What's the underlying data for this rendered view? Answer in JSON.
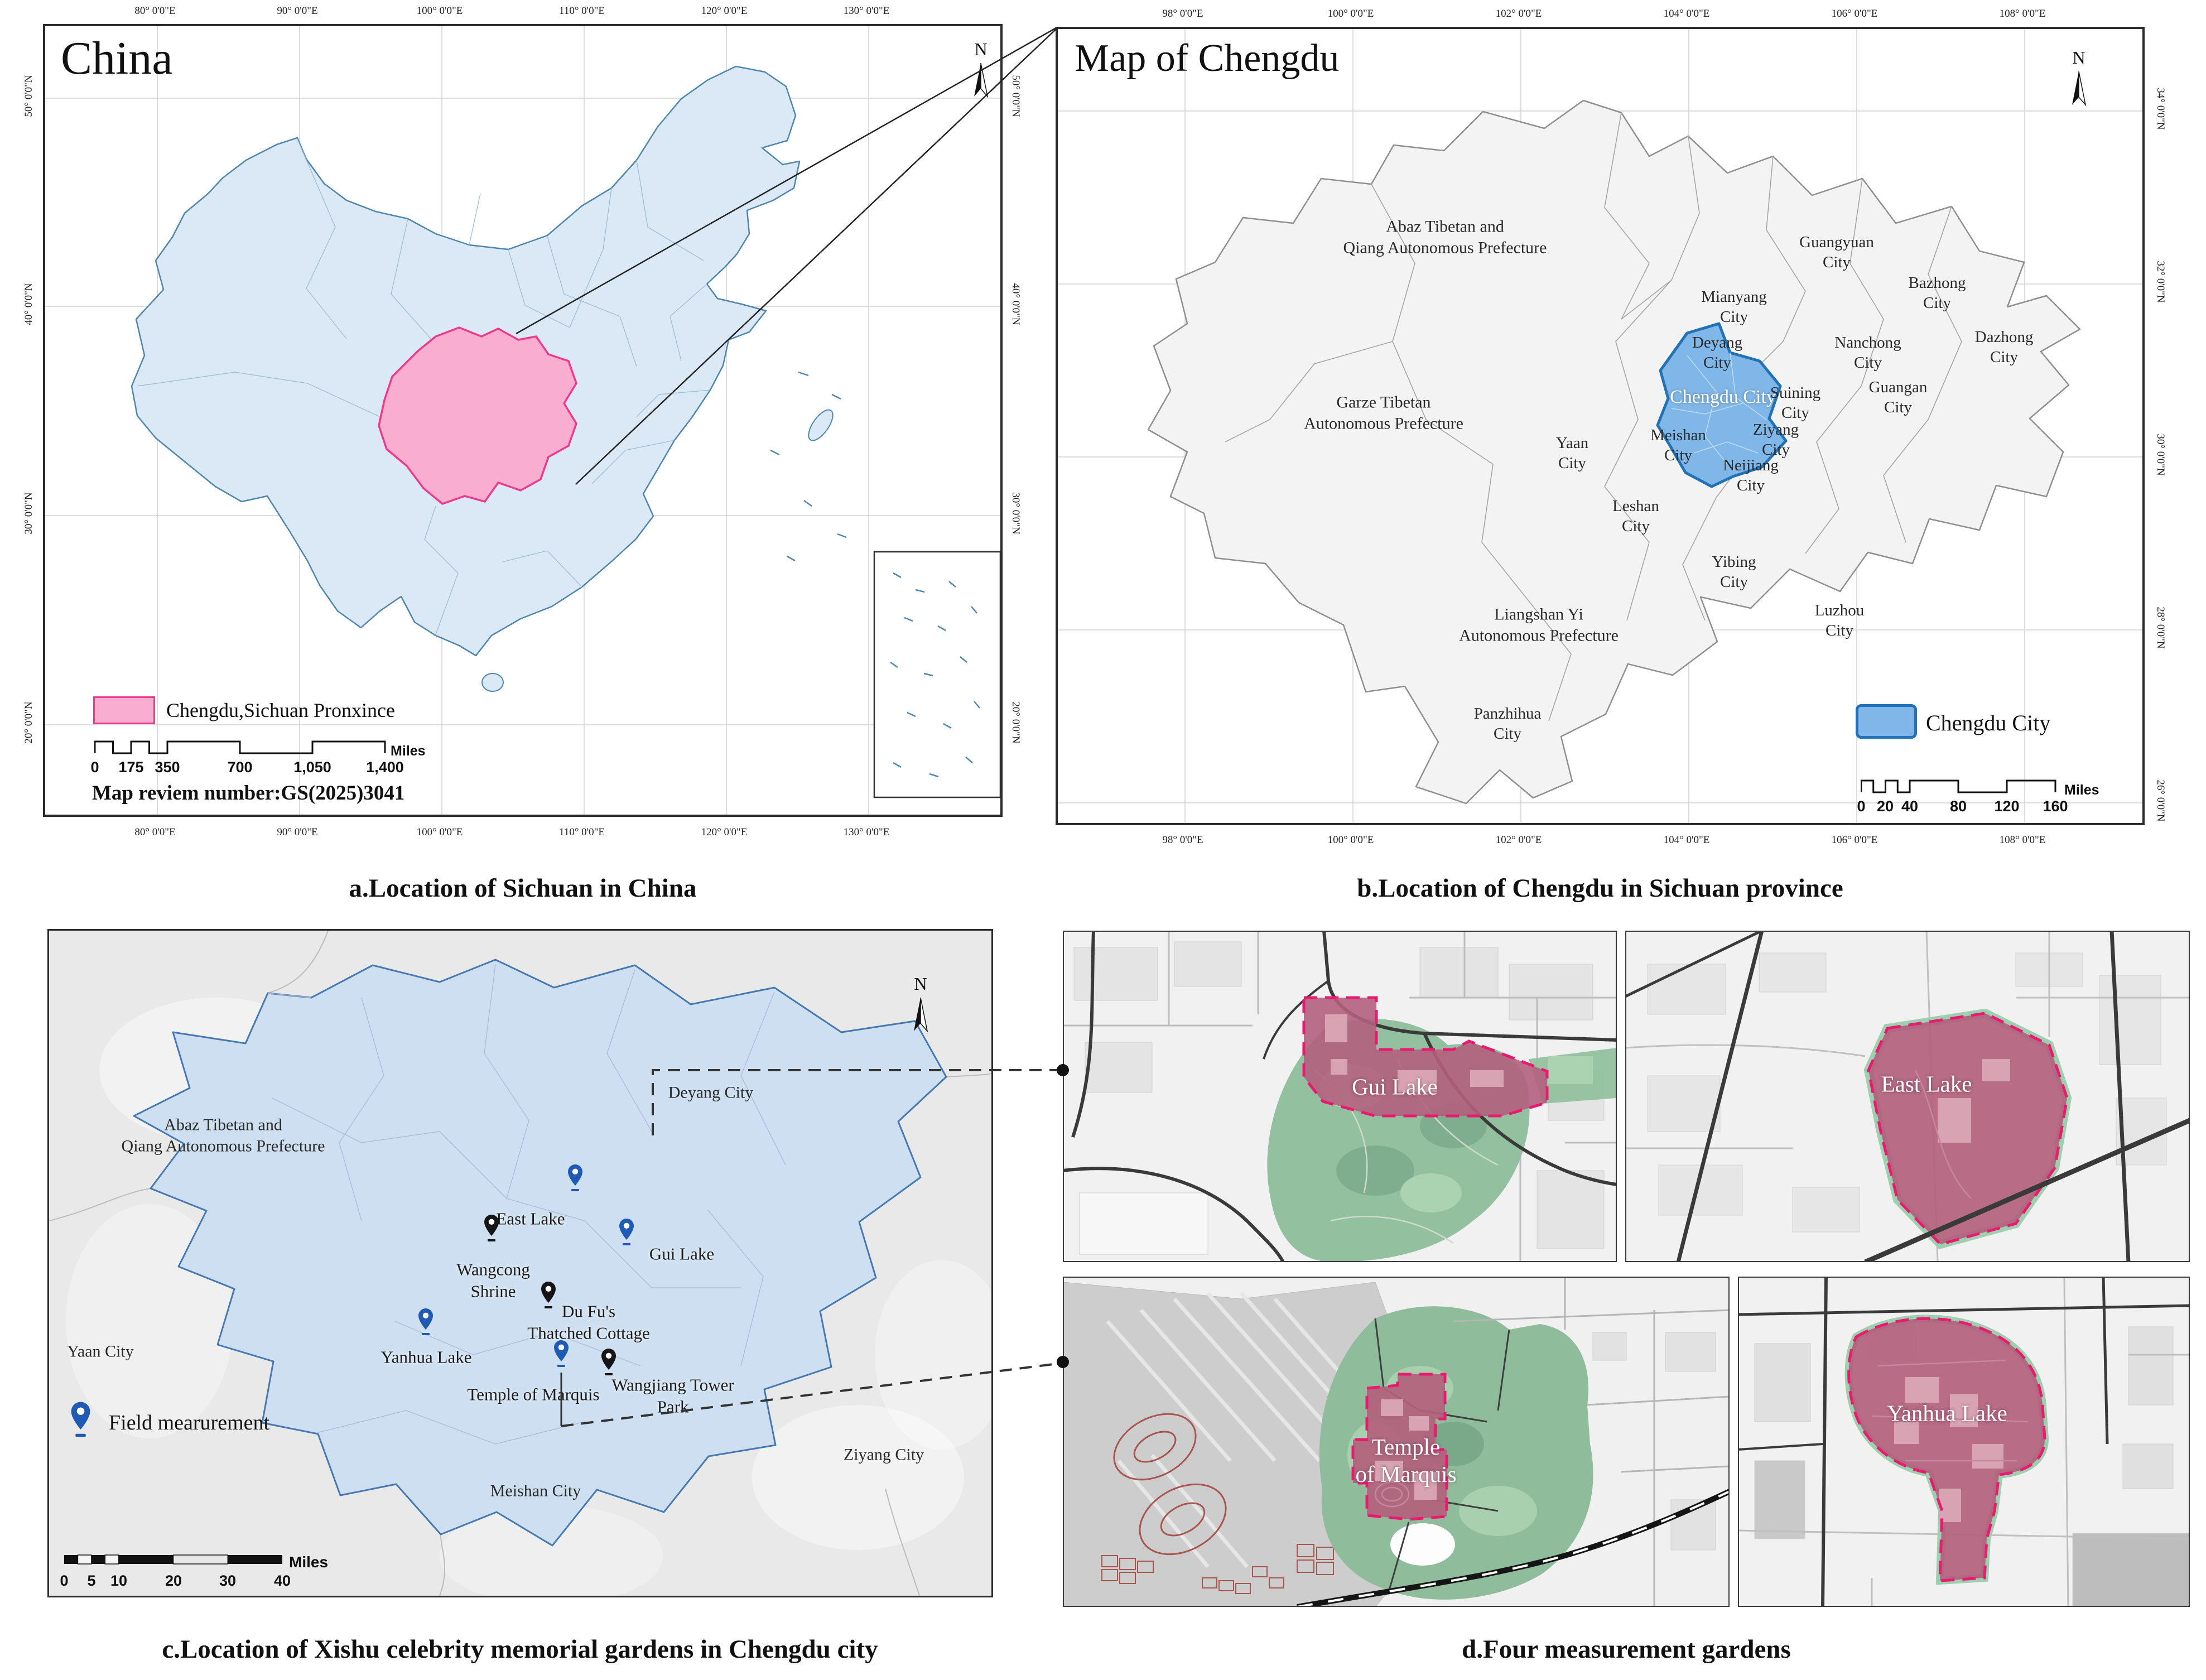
{
  "colors": {
    "china_fill": "#dbe9f6",
    "china_border": "#4e86ad",
    "sichuan_pink": "#f9aed0",
    "pink_border": "#ee3a8c",
    "chengdu_blue": "#7fb7e8",
    "blue_border": "#2272b5",
    "plain_blue": "#cddff0",
    "plain_border": "#4679b2",
    "garden_pink": "#b3617d",
    "garden_dash": "#ea1a70",
    "park_green": "#92c09f",
    "pin_blue": "#1f5bb5",
    "pin_black": "#151515"
  },
  "panel_a": {
    "title": "China",
    "caption": "a.Location of Sichuan in China",
    "north": "N",
    "legend_label": "Chengdu,Sichuan Pronxince",
    "note": "Map reviem number:GS(2025)3041",
    "scalebar": {
      "ticks": [
        "0",
        "175",
        "350",
        "700",
        "1,050",
        "1,400"
      ],
      "unit": "Miles"
    },
    "x_ticks": [
      "80° 0'0\"E",
      "90° 0'0\"E",
      "100° 0'0\"E",
      "110° 0'0\"E",
      "120° 0'0\"E",
      "130° 0'0\"E"
    ],
    "y_ticks": [
      "50° 0'0\"N",
      "40° 0'0\"N",
      "30° 0'0\"N",
      "20° 0'0\"N"
    ]
  },
  "panel_b": {
    "title": "Map of Chengdu",
    "caption": "b.Location of Chengdu in Sichuan province",
    "north": "N",
    "legend_label": "Chengdu City",
    "scalebar": {
      "ticks": [
        "0",
        "20",
        "40",
        "80",
        "120",
        "160"
      ],
      "unit": "Miles"
    },
    "x_ticks": [
      "98° 0'0\"E",
      "100° 0'0\"E",
      "102° 0'0\"E",
      "104° 0'0\"E",
      "106° 0'0\"E",
      "108° 0'0\"E"
    ],
    "y_ticks": [
      "34° 0'0\"N",
      "32° 0'0\"N",
      "30° 0'0\"N",
      "28° 0'0\"N",
      "26° 0'0\"N"
    ],
    "regions": [
      "Abaz Tibetan and\nQiang Autonomous Prefecture",
      "Garze Tibetan\nAutonomous Prefecture",
      "Guangyuan\nCity",
      "Bazhong\nCity",
      "Mianyang\nCity",
      "Deyang\nCity",
      "Nanchong\nCity",
      "Dazhong\nCity",
      "Chengdu City",
      "Suining\nCity",
      "Guangan\nCity",
      "Ziyang\nCity",
      "Meishan\nCity",
      "Neijiang\nCity",
      "Yaan\nCity",
      "Leshan\nCity",
      "Yibing\nCity",
      "Luzhou\nCity",
      "Liangshan Yi\nAutonomous Prefecture",
      "Panzhihua\nCity"
    ]
  },
  "panel_c": {
    "caption": "c.Location of Xishu celebrity memorial gardens in Chengdu city",
    "north": "N",
    "legend_label": "Field mearurement",
    "scalebar": {
      "ticks": [
        "0",
        "5",
        "10",
        "20",
        "30",
        "40"
      ],
      "unit": "Miles"
    },
    "labels": [
      "Abaz Tibetan and\nQiang Autonomous Prefecture",
      "Deyang City",
      "Yaan City",
      "Meishan City",
      "Ziyang City"
    ],
    "markers": [
      {
        "label": "East Lake",
        "pin": "blue"
      },
      {
        "label": "Gui Lake",
        "pin": "blue"
      },
      {
        "label": "Wangcong\nShrine",
        "pin": "black"
      },
      {
        "label": "Du Fu's\nThatched Cottage",
        "pin": "black"
      },
      {
        "label": "Yanhua Lake",
        "pin": "blue"
      },
      {
        "label": "Temple of Marquis",
        "pin": "blue"
      },
      {
        "label": "Wangjiang Tower\nPark",
        "pin": "black"
      }
    ]
  },
  "panel_d": {
    "caption": "d.Four measurement gardens",
    "gardens": [
      "Gui Lake",
      "East Lake",
      "Temple\nof Marquis",
      "Yanhua Lake"
    ]
  }
}
